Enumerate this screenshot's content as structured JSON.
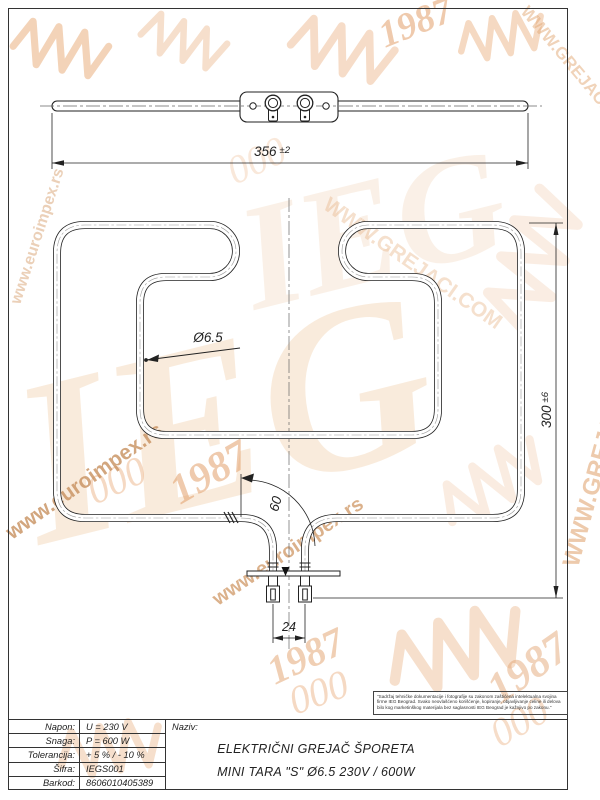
{
  "drawing": {
    "dim_width_value": "356",
    "dim_width_tol": "±2",
    "dim_height_value": "300",
    "dim_height_tol": "±6",
    "dim_diameter": "Ø6.5",
    "dim_bend": "60",
    "dim_pins": "24"
  },
  "title_block": {
    "naziv_label": "Naziv:",
    "title_line1": "ELEKTRIČNI GREJAČ ŠPORETA",
    "title_line2": "MINI TARA \"S\" Ø6.5 230V / 600W",
    "rows": [
      {
        "label": "Napon:",
        "value": "U =  230  V"
      },
      {
        "label": "Snaga:",
        "value": "P =  600 W"
      },
      {
        "label": "Tolerancija:",
        "value": "+ 5 %  /  - 10 %"
      },
      {
        "label": "Šifra:",
        "value": "IEGS001"
      },
      {
        "label": "Barkod:",
        "value": "8606010405389"
      }
    ]
  },
  "disclaimer": {
    "text": "\"Sadržaj tehničke dokumentacije i fotografije su zakonom zaštićena intelektualna svojina firme IEG Beograd. Svako neovlašćeno korišćenje, kopiranje, objavljivanje celine ili delova bilo kog marketinškog materijala bez saglasnosti IEG Beograd je kažnjivo po zakonu.\""
  },
  "watermarks": {
    "brand": "IEG",
    "year": "1987",
    "loops": "000",
    "site1": "www.euroimpex.rs",
    "site2": "WWW.GREJACI.COM",
    "accent_color": "#e8a76f"
  }
}
